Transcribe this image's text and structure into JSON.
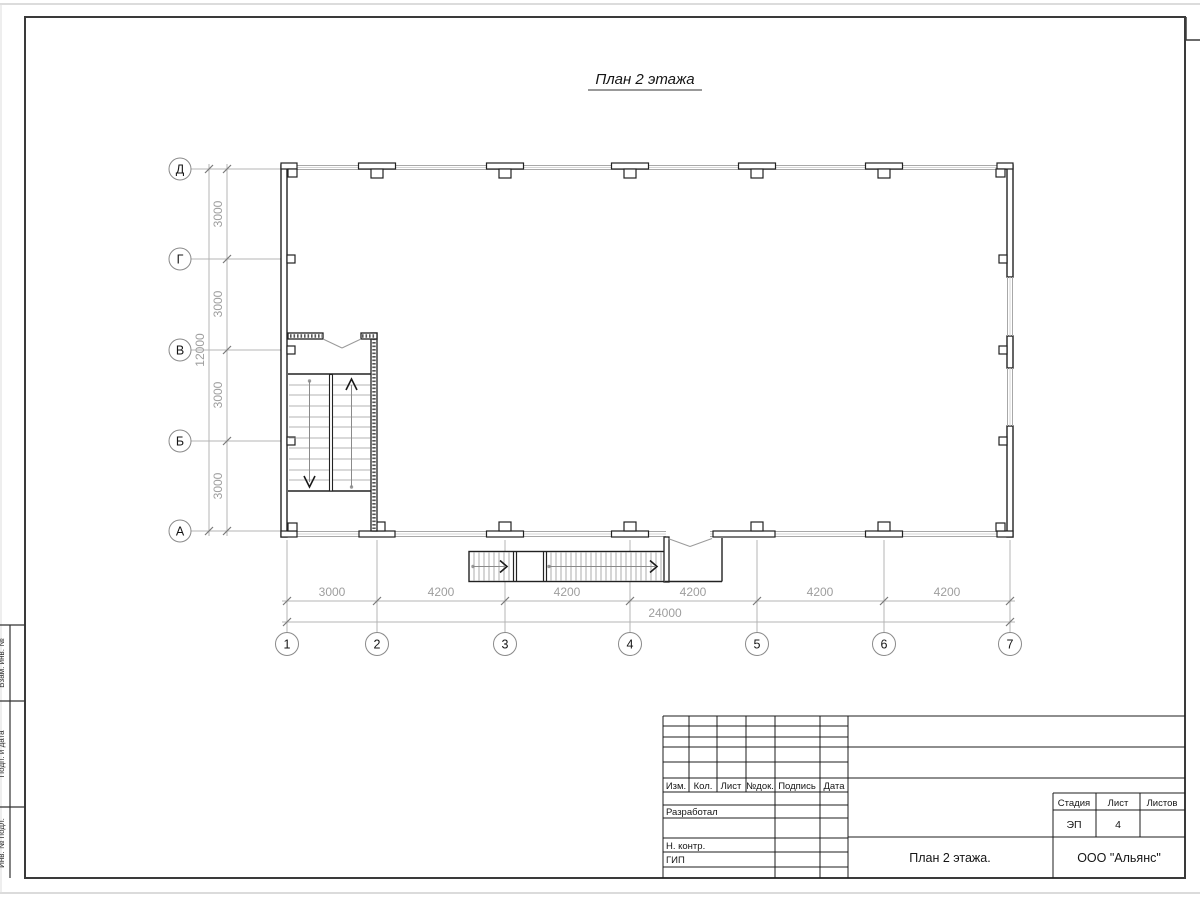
{
  "drawing_title": "План 2 этажа",
  "grid": {
    "column_axes": [
      "1",
      "2",
      "3",
      "4",
      "5",
      "6",
      "7"
    ],
    "row_axes": [
      "Д",
      "Г",
      "В",
      "Б",
      "А"
    ]
  },
  "dimensions": {
    "bottom_segments": [
      "3000",
      "4200",
      "4200",
      "4200",
      "4200",
      "4200"
    ],
    "bottom_total": "24000",
    "left_segments": [
      "3000",
      "3000",
      "3000",
      "3000"
    ],
    "left_total": "12000"
  },
  "title_block": {
    "revision_headers": [
      "Изм.",
      "Кол.",
      "Лист",
      "№док.",
      "Подпись",
      "Дата"
    ],
    "role_labels": [
      "Разработал",
      "Н. контр.",
      "ГИП"
    ],
    "stage_header": "Стадия",
    "sheet_header": "Лист",
    "sheets_header": "Листов",
    "stage_value": "ЭП",
    "sheet_value": "4",
    "sheets_value": "",
    "document_title": "План 2 этажа.",
    "company": "ООО \"Альянс\""
  },
  "frame_side_labels": [
    "Взам. инв. №",
    "Подп. и дата",
    "Инв. № подл."
  ]
}
